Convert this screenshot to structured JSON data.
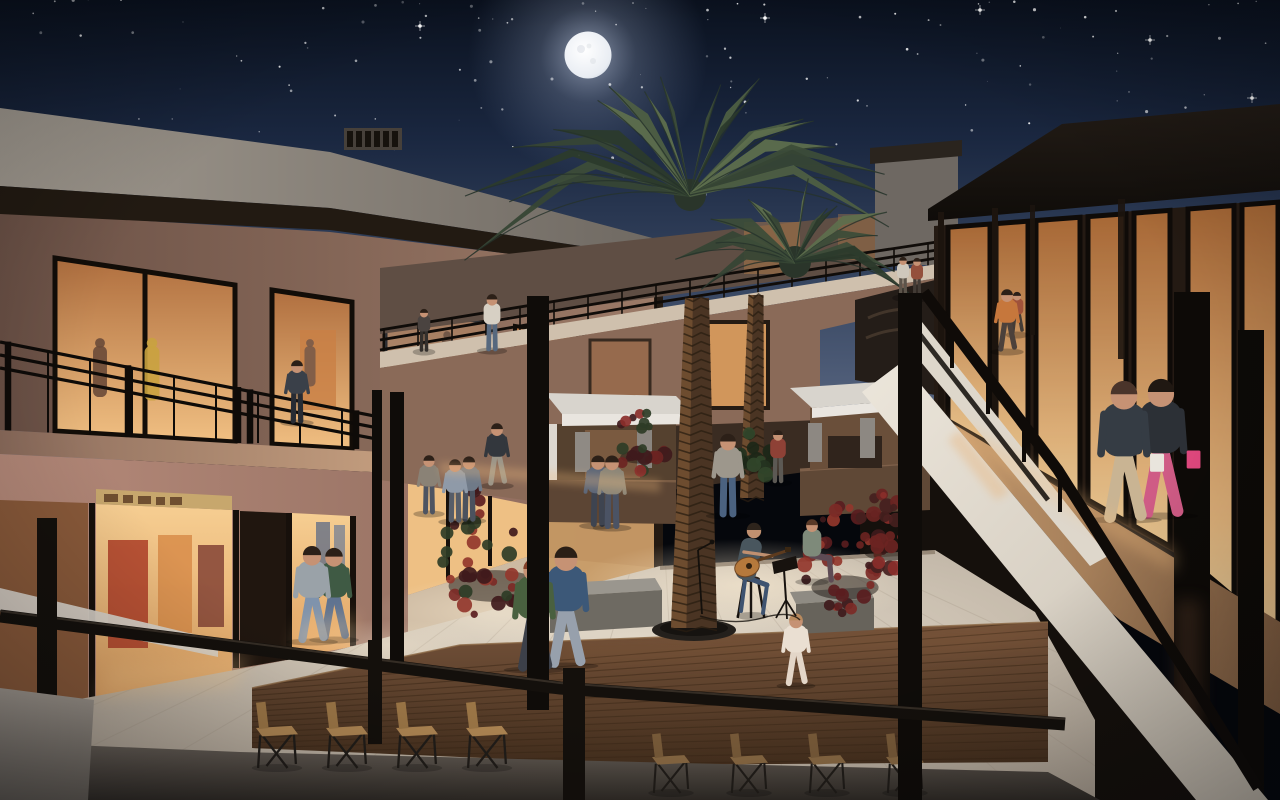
{
  "scene": {
    "type": "architectural-rendering",
    "subject": "outdoor shopping mall courtyard at night",
    "description": "Night-time 3D rendering of a two-story open-air retail center courtyard: full moon and starry sky, tall date palms in the middle, warmly lit storefronts on both levels, white kiosks, red shrubs, a wooden deck with rows of chairs, shoppers strolling and a street musician playing guitar.",
    "time_of_day": "night",
    "signage_legible": false
  },
  "palette": {
    "sky_top": "#0a111e",
    "sky_mid": "#1a2740",
    "sky_horizon": "#5f6d86",
    "moon": "#eef1f5",
    "window_glow": "#f2c185",
    "window_frame": "#14100c",
    "wall_warm": "#a5796a",
    "parapet": "#968e84",
    "canopy_dark": "#1a1410",
    "white_fascia": "#e4ddd1",
    "deck_wood": "#6b4a31",
    "plaza": "#d5cabb",
    "palm_frond": "#45543c",
    "palm_trunk": "#5c3f28",
    "shrub_red": "#7c2a26",
    "railing": "#0f0b08",
    "chair_seat": "#b08754"
  },
  "sky": {
    "stars": {
      "count": 175,
      "seed": 11,
      "bright": [
        [
          765,
          18
        ],
        [
          1150,
          40
        ],
        [
          420,
          26
        ],
        [
          980,
          10
        ],
        [
          1252,
          98
        ]
      ]
    },
    "moon": {
      "cx": 588,
      "cy": 55,
      "r": 23
    }
  },
  "counts": {
    "people": 24,
    "window_mannequins": 5,
    "palm_trees": 2,
    "kiosks": 2,
    "chairs": 8,
    "shrubs": 5,
    "benches": 2
  },
  "people": [
    {
      "name": "man-leaning-on-left-railing",
      "pose": "stand",
      "x": 297,
      "y": 421,
      "h": 62,
      "top": "#3a4049",
      "bottom": "#272b33"
    },
    {
      "name": "walker-upper-left",
      "pose": "stand",
      "x": 424,
      "y": 350,
      "h": 42,
      "top": "#4a4340",
      "bottom": "#332f2c"
    },
    {
      "name": "man-white-shirt-upper",
      "pose": "stand",
      "x": 492,
      "y": 349,
      "h": 56,
      "top": "#d7d0c4",
      "bottom": "#56687e"
    },
    {
      "name": "bridge-man",
      "pose": "stand",
      "x": 903,
      "y": 296,
      "h": 40,
      "top": "#cfc8bc",
      "bottom": "#5c544a"
    },
    {
      "name": "bridge-woman",
      "pose": "stand",
      "x": 917,
      "y": 297,
      "h": 40,
      "top": "#94503c",
      "bottom": "#423b35"
    },
    {
      "name": "man-orange-shirt",
      "pose": "walk",
      "x": 1007,
      "y": 350,
      "h": 62,
      "top": "#c6773c",
      "bottom": "#4c413b"
    },
    {
      "name": "walker-far-right-walkway",
      "pose": "walk",
      "x": 1017,
      "y": 333,
      "h": 42,
      "top": "#a0523a",
      "bottom": "#443c36"
    },
    {
      "name": "shopper-with-bag",
      "pose": "walk",
      "x": 1124,
      "y": 518,
      "h": 140,
      "top": "#353c44",
      "bottom": "#c9b493",
      "bag": "#e9e5dd",
      "hair": "#4a342a"
    },
    {
      "name": "shopper-pink-skirt",
      "pose": "walk",
      "x": 1161,
      "y": 514,
      "h": 138,
      "top": "#2c3036",
      "bottom": "#cf5b85",
      "bag": "#e0487e",
      "hair": "#201812"
    },
    {
      "name": "man-blue-blazer",
      "pose": "walk",
      "x": 566,
      "y": 664,
      "h": 120,
      "top": "#3c5878",
      "bottom": "#97a0ac",
      "hair": "#2a1f16"
    },
    {
      "name": "woman-green-jacket",
      "pose": "walk",
      "x": 534,
      "y": 668,
      "h": 112,
      "top": "#49603f",
      "bottom": "#3c4049",
      "hair": "#83412a"
    },
    {
      "name": "corridor-man",
      "pose": "walk",
      "x": 312,
      "y": 640,
      "h": 96,
      "top": "#9aa2a8",
      "bottom": "#7f93ac"
    },
    {
      "name": "corridor-woman",
      "pose": "walk",
      "x": 334,
      "y": 638,
      "h": 92,
      "top": "#3f5a44",
      "bottom": "#5f7390"
    },
    {
      "name": "man-dark-vest",
      "pose": "walk",
      "x": 497,
      "y": 484,
      "h": 62,
      "top": "#33373d",
      "bottom": "#9b9588"
    },
    {
      "name": "stander-a1",
      "pose": "stand",
      "x": 455,
      "y": 520,
      "h": 62,
      "top": "#8f9aa8",
      "bottom": "#565d68"
    },
    {
      "name": "stander-a2",
      "pose": "stand",
      "x": 469,
      "y": 519,
      "h": 64,
      "top": "#6f7a88",
      "bottom": "#4b525e"
    },
    {
      "name": "stander-b1",
      "pose": "stand",
      "x": 429,
      "y": 512,
      "h": 58,
      "top": "#8a8276",
      "bottom": "#4e5461"
    },
    {
      "name": "stander-c1",
      "pose": "stand",
      "x": 598,
      "y": 524,
      "h": 70,
      "top": "#5c6678",
      "bottom": "#3e4450"
    },
    {
      "name": "stander-c2",
      "pose": "stand",
      "x": 612,
      "y": 526,
      "h": 72,
      "top": "#8c8678",
      "bottom": "#4b5364"
    },
    {
      "name": "man-gray-tshirt",
      "pose": "stand",
      "x": 728,
      "y": 514,
      "h": 82,
      "top": "#9d978c",
      "bottom": "#4b6280"
    },
    {
      "name": "woman-red-top",
      "pose": "stand",
      "x": 778,
      "y": 481,
      "h": 52,
      "top": "#8e4136",
      "bottom": "#5c5954"
    },
    {
      "name": "woman-on-bench",
      "pose": "sit",
      "x": 812,
      "y": 580,
      "h": 62,
      "top": "#7e8a7a",
      "bottom": "#5e4b54",
      "hair": "#5a3a28",
      "dir": -1
    },
    {
      "name": "child-white-dress",
      "pose": "walk",
      "x": 796,
      "y": 684,
      "h": 72,
      "top": "#eadfd2",
      "bottom": "#e3d6c8",
      "hair": "#b98a5e"
    }
  ],
  "window_mannequins": [
    {
      "x": 100,
      "y": 404,
      "h": 58,
      "c": "#6a4a38"
    },
    {
      "x": 152,
      "y": 408,
      "h": 62,
      "c": "#c9a23f"
    },
    {
      "x": 310,
      "y": 392,
      "h": 46,
      "c": "#7a5a48"
    },
    {
      "x": 447,
      "y": 382,
      "h": 44,
      "c": "#6b5244"
    },
    {
      "x": 573,
      "y": 380,
      "h": 40,
      "c": "#8a6a50"
    }
  ],
  "vegetation": {
    "palm_trunks": [
      {
        "id": "trunk1",
        "bx": 694,
        "by": 628,
        "tx": 697,
        "ty": 298,
        "bw": 46,
        "tw": 24
      },
      {
        "id": "trunk2",
        "bx": 752,
        "by": 498,
        "tx": 756,
        "ty": 295,
        "bw": 24,
        "tw": 15
      }
    ],
    "palm_crowns": [
      {
        "cx": 690,
        "cy": 195,
        "len": 215,
        "ys": 0.62,
        "n": 18,
        "seed": 5
      },
      {
        "cx": 795,
        "cy": 262,
        "len": 130,
        "ys": 0.6,
        "n": 13,
        "seed": 8
      }
    ],
    "shrubs": [
      {
        "cx": 495,
        "cy": 550,
        "rx": 58,
        "ry": 72,
        "n": 46,
        "seed": 3,
        "layer": "front",
        "colors": [
          "#5a1d1f",
          "#7c2a26",
          "#93372c",
          "#3f1a1c",
          "#2e3c26"
        ]
      },
      {
        "cx": 845,
        "cy": 560,
        "rx": 42,
        "ry": 55,
        "n": 36,
        "seed": 4,
        "layer": "front",
        "colors": [
          "#5a1d1f",
          "#7c2a26",
          "#93372c",
          "#3f1a1c"
        ]
      },
      {
        "cx": 888,
        "cy": 532,
        "rx": 30,
        "ry": 40,
        "n": 26,
        "seed": 6,
        "layer": "front",
        "colors": [
          "#6b2422",
          "#8a2e2a",
          "#45201e"
        ]
      },
      {
        "cx": 641,
        "cy": 442,
        "rx": 26,
        "ry": 30,
        "n": 22,
        "seed": 7,
        "layer": "back",
        "colors": [
          "#6b2422",
          "#8a2e2a",
          "#3f1a1c",
          "#2e3c26"
        ]
      },
      {
        "cx": 750,
        "cy": 455,
        "rx": 24,
        "ry": 26,
        "n": 20,
        "seed": 9,
        "layer": "back",
        "colors": [
          "#24321f",
          "#31452a",
          "#1c2718"
        ]
      }
    ]
  },
  "furniture": {
    "chair_rows": [
      {
        "y": 770,
        "s": 1.05,
        "xs": [
          256,
          326,
          396,
          466
        ],
        "seat": "#b08754",
        "back": "#9d7747"
      },
      {
        "y": 795,
        "s": 0.95,
        "xs": [
          652,
          730,
          808,
          886
        ],
        "seat": "#8a6a44",
        "back": "#7a5c3a"
      }
    ],
    "music_setup": {
      "musician": {
        "x": 752,
        "y": 614,
        "top": "#49565e",
        "bottom": "#3e5370",
        "skin": "#c09070",
        "hair": "#2e241c"
      },
      "guitar": {
        "cx": 747,
        "cy": 567,
        "color": "#b5793c"
      },
      "stool": {
        "x": 751,
        "y": 618
      },
      "music_stand": {
        "x": 784,
        "y": 618
      },
      "mic_stand": {
        "x": 702,
        "y": 614
      }
    }
  }
}
